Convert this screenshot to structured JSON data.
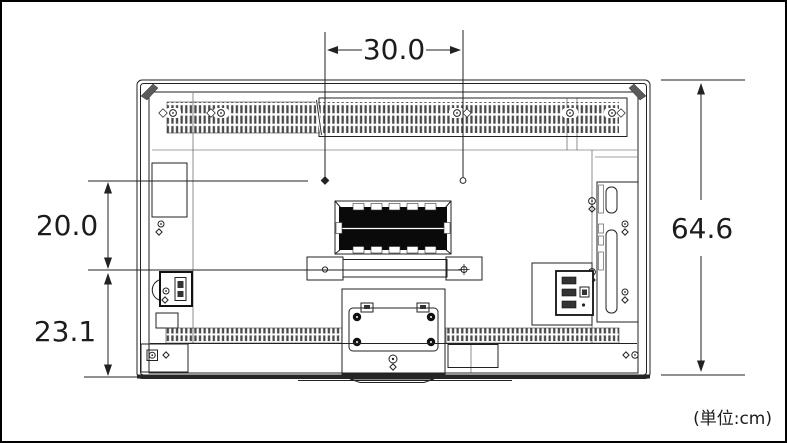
{
  "figure": {
    "unit_note": "(単位:cm)",
    "dimensions": {
      "top_width": "30.0",
      "upper_height": "20.0",
      "lower_height": "23.1",
      "total_height": "64.6"
    },
    "colors": {
      "background": "#ffffff",
      "line": "#222222",
      "border": "#000000",
      "recess_fill": "#0a0a0a",
      "grille_slot": "#4a4a4a"
    }
  }
}
